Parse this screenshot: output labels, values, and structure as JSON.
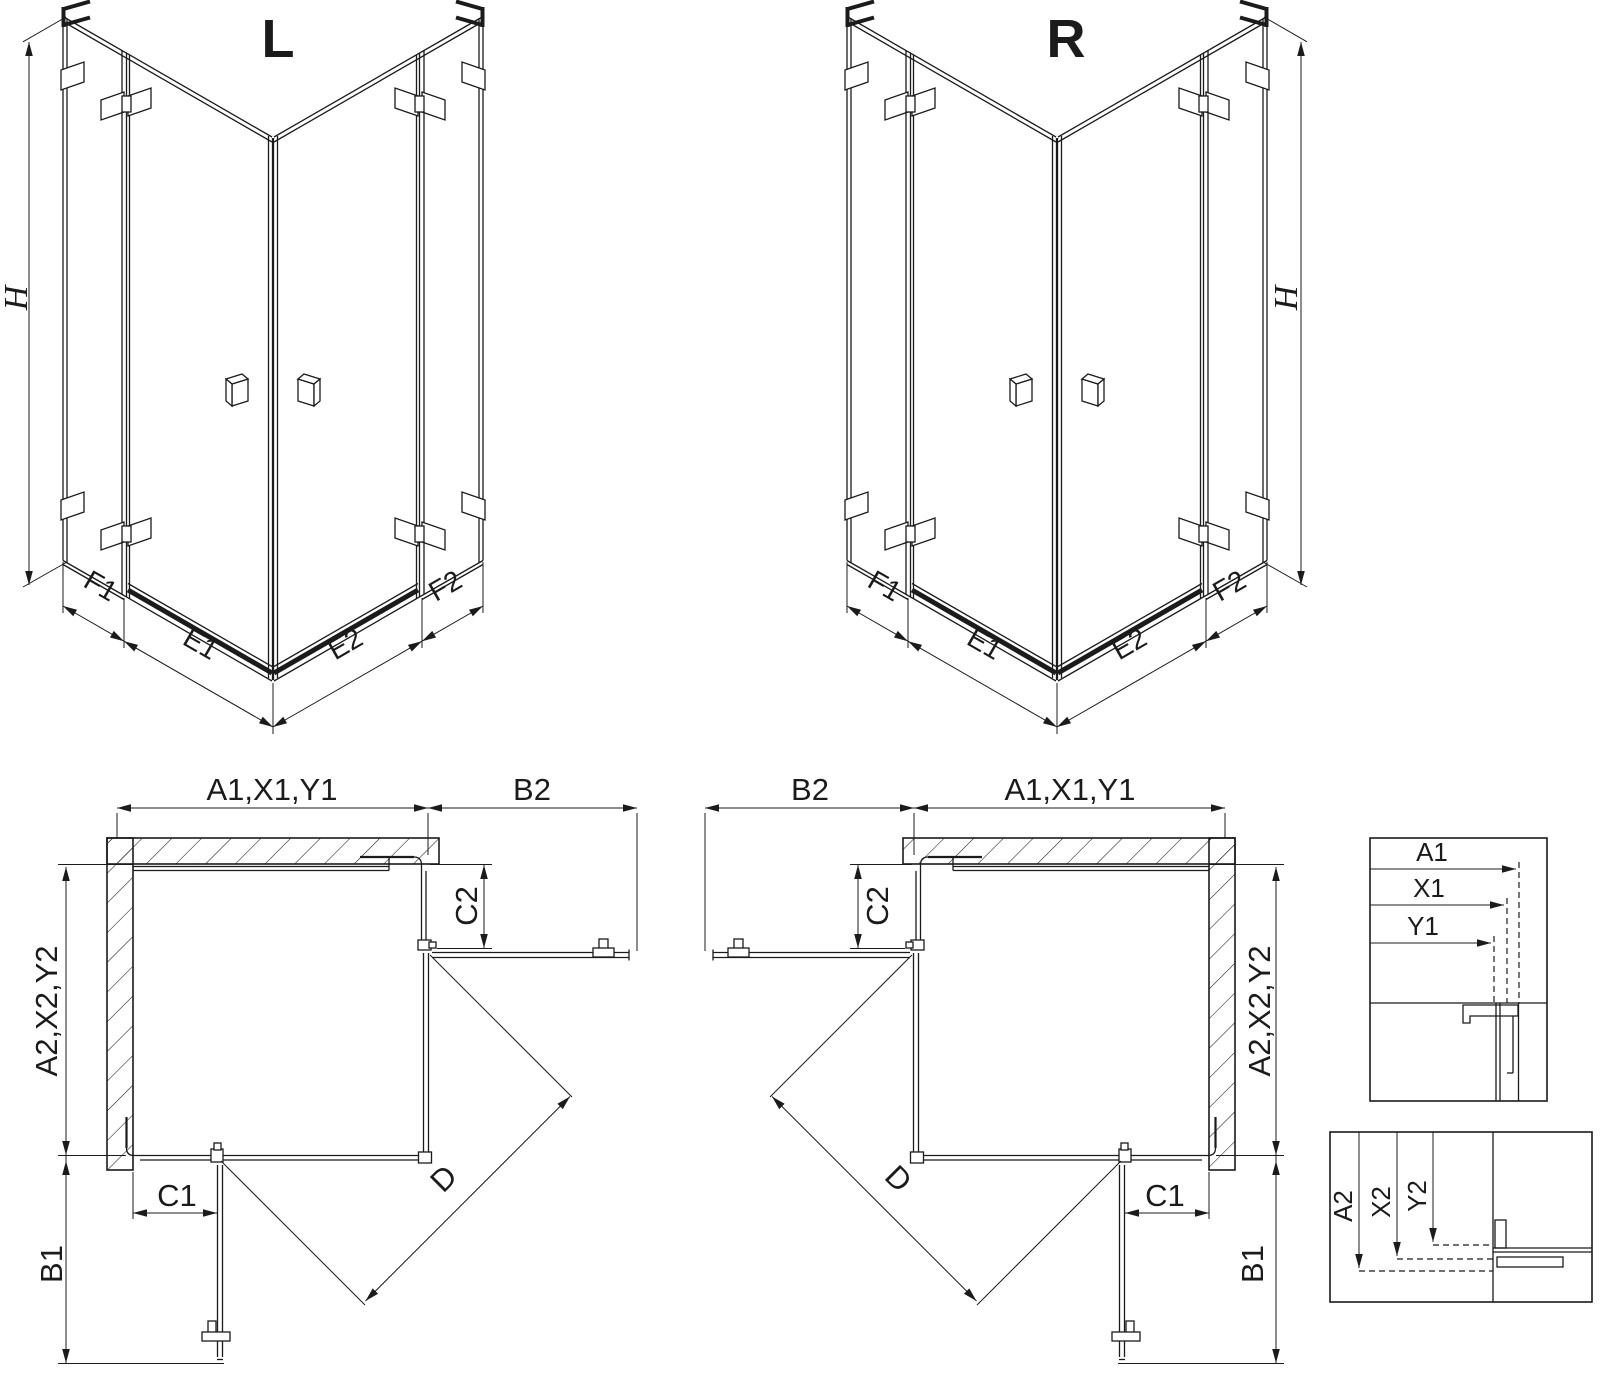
{
  "drawing": {
    "type": "shower-enclosure-technical-drawing",
    "colors": {
      "line": "#1b1b1b",
      "background": "#ffffff"
    }
  },
  "iso_left": {
    "variant": "L",
    "height": "H",
    "f1": "F1",
    "e1": "E1",
    "e2": "E2",
    "f2": "F2"
  },
  "iso_right": {
    "variant": "R",
    "height": "H",
    "f1": "F1",
    "e1": "E1",
    "e2": "E2",
    "f2": "F2"
  },
  "plan_left": {
    "width": "A1,X1,Y1",
    "b2": "B2",
    "c2": "C2",
    "depth": "A2,X2,Y2",
    "c1": "C1",
    "b1": "B1",
    "d": "D"
  },
  "plan_right": {
    "width": "A1,X1,Y1",
    "b2": "B2",
    "c2": "C2",
    "depth": "A2,X2,Y2",
    "c1": "C1",
    "b1": "B1",
    "d": "D"
  },
  "detail_top": {
    "a1": "A1",
    "x1": "X1",
    "y1": "Y1"
  },
  "detail_bottom": {
    "a2": "A2",
    "x2": "X2",
    "y2": "Y2"
  }
}
